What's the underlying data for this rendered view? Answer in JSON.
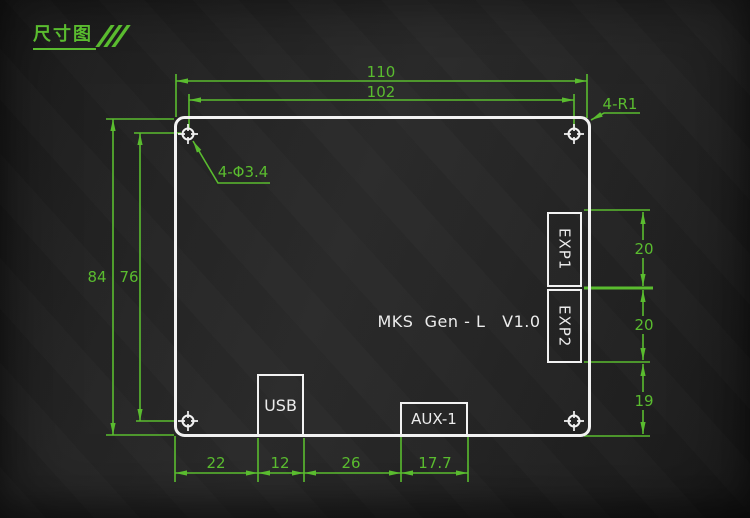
{
  "page": {
    "title": "尺寸图"
  },
  "board": {
    "model_label": "MKS  Gen - L   V1.0"
  },
  "connectors": {
    "exp1": "EXP1",
    "exp2": "EXP2",
    "usb": "USB",
    "aux1": "AUX-1"
  },
  "dimensions": {
    "outer_width": "110",
    "hole_span_width": "102",
    "outer_height": "84",
    "hole_span_height": "76",
    "exp1_height": "20",
    "exp2_height": "20",
    "exp2_to_bottom": "19",
    "bottom_seg1": "22",
    "bottom_seg2": "12",
    "bottom_seg3": "26",
    "bottom_seg4": "17.7",
    "corner_radius_note": "4-R1",
    "hole_diameter_note": "4-Φ3.4"
  },
  "colors": {
    "dimension_green": "#5abc2f",
    "outline_white": "#f2f2f2",
    "background": "#242424"
  }
}
